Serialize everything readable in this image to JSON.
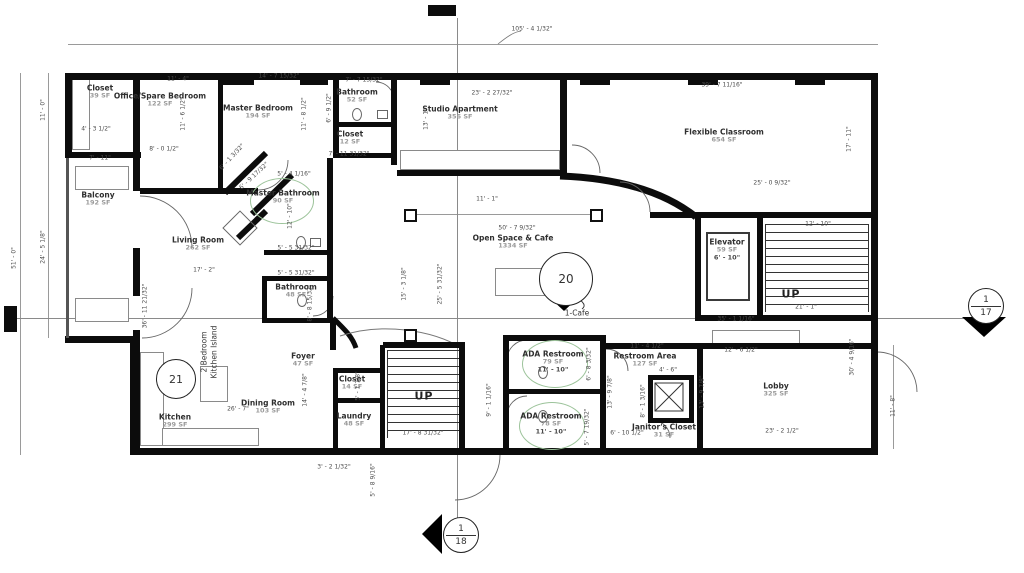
{
  "drawing": {
    "type": "architectural floor plan"
  },
  "colors": {
    "wall": "#0c0c0c",
    "room_label": "#2f2f2f",
    "area_label": "#9a9a9a",
    "dimension": "#4a4a4a",
    "revision_cloud": "#9cc39a"
  },
  "rooms": [
    {
      "name": "Closet",
      "area": "39 SF",
      "x": 100,
      "y": 92
    },
    {
      "name": "Office/Spare Bedroom",
      "area": "122 SF",
      "x": 160,
      "y": 100
    },
    {
      "name": "Master Bedroom",
      "area": "194 SF",
      "x": 258,
      "y": 112
    },
    {
      "name": "Bathroom",
      "area": "52 SF",
      "x": 357,
      "y": 96
    },
    {
      "name": "Closet",
      "area": "12 SF",
      "x": 350,
      "y": 138
    },
    {
      "name": "Studio Apartment",
      "area": "356 SF",
      "x": 460,
      "y": 113
    },
    {
      "name": "Flexible Classroom",
      "area": "654 SF",
      "x": 724,
      "y": 136
    },
    {
      "name": "Balcony",
      "area": "192 SF",
      "x": 98,
      "y": 199
    },
    {
      "name": "Master Bathroom",
      "area": "90 SF",
      "x": 283,
      "y": 197
    },
    {
      "name": "Living Room",
      "area": "262 SF",
      "x": 198,
      "y": 244
    },
    {
      "name": "Bathroom",
      "area": "48 SF",
      "x": 296,
      "y": 291
    },
    {
      "name": "Open Space & Cafe",
      "area": "1334 SF",
      "x": 513,
      "y": 242
    },
    {
      "name": "Elevator",
      "area": "59 SF",
      "extra": "6' - 10\"",
      "x": 727,
      "y": 250
    },
    {
      "name": "Kitchen",
      "area": "299 SF",
      "x": 175,
      "y": 421
    },
    {
      "name": "Dining Room",
      "area": "103 SF",
      "x": 268,
      "y": 407
    },
    {
      "name": "Foyer",
      "area": "47 SF",
      "x": 303,
      "y": 360
    },
    {
      "name": "Closet",
      "area": "14 SF",
      "x": 352,
      "y": 383
    },
    {
      "name": "Laundry",
      "area": "48 SF",
      "x": 354,
      "y": 420
    },
    {
      "name": "ADA Restroom",
      "area": "79 SF",
      "extra": "11' - 10\"",
      "x": 553,
      "y": 362
    },
    {
      "name": "ADA Restroom",
      "area": "78 SF",
      "extra": "11' - 10\"",
      "x": 551,
      "y": 424
    },
    {
      "name": "Restroom Area",
      "area": "127 SF",
      "x": 645,
      "y": 360
    },
    {
      "name": "Janitor's Closet",
      "area": "31 SF",
      "x": 664,
      "y": 431
    },
    {
      "name": "Lobby",
      "area": "325 SF",
      "x": 776,
      "y": 390
    }
  ],
  "dimensions": [
    {
      "text": "105' - 4 1/32\"",
      "x": 532,
      "y": 29,
      "rot": 0
    },
    {
      "text": "11' - 4\"",
      "x": 178,
      "y": 79,
      "rot": 0
    },
    {
      "text": "14' - 7 15/32\"",
      "x": 279,
      "y": 76,
      "rot": 0
    },
    {
      "text": "7' - 7 15/32\"",
      "x": 364,
      "y": 80,
      "rot": 0
    },
    {
      "text": "23' - 2 27/32\"",
      "x": 492,
      "y": 93,
      "rot": 0
    },
    {
      "text": "39' - 7 11/16\"",
      "x": 722,
      "y": 85,
      "rot": 0
    },
    {
      "text": "51' - 0\"",
      "x": 14,
      "y": 258,
      "rot": -90
    },
    {
      "text": "11' - 0\"",
      "x": 43,
      "y": 110,
      "rot": -90
    },
    {
      "text": "24' - 5 1/8\"",
      "x": 43,
      "y": 247,
      "rot": -90
    },
    {
      "text": "4' - 3 1/2\"",
      "x": 96,
      "y": 129,
      "rot": 0
    },
    {
      "text": "7' - 11\"",
      "x": 100,
      "y": 158,
      "rot": 0
    },
    {
      "text": "8' - 0 1/2\"",
      "x": 164,
      "y": 149,
      "rot": 0
    },
    {
      "text": "11' - 6 1/2\"",
      "x": 183,
      "y": 114,
      "rot": -90
    },
    {
      "text": "11' - 8 1/2\"",
      "x": 304,
      "y": 114,
      "rot": -90
    },
    {
      "text": "6' - 9 1/2\"",
      "x": 329,
      "y": 108,
      "rot": -90
    },
    {
      "text": "7' - 11 31/32\"",
      "x": 349,
      "y": 154,
      "rot": 0
    },
    {
      "text": "13' - 1\"",
      "x": 426,
      "y": 119,
      "rot": -90
    },
    {
      "text": "17' - 11\"",
      "x": 849,
      "y": 139,
      "rot": -90
    },
    {
      "text": "25' - 0 9/32\"",
      "x": 772,
      "y": 183,
      "rot": 0
    },
    {
      "text": "6' - 1 3/32\"",
      "x": 232,
      "y": 157,
      "rot": -47
    },
    {
      "text": "6' - 9 17/32\"",
      "x": 254,
      "y": 176,
      "rot": -43
    },
    {
      "text": "5' - 4 1/16\"",
      "x": 294,
      "y": 174,
      "rot": 0
    },
    {
      "text": "12' - 10\"",
      "x": 290,
      "y": 216,
      "rot": -90
    },
    {
      "text": "5' - 5 31/32\"",
      "x": 296,
      "y": 248,
      "rot": 0
    },
    {
      "text": "5' - 5 31/32\"",
      "x": 296,
      "y": 273,
      "rot": 0
    },
    {
      "text": "8' - 8 15/32\"",
      "x": 310,
      "y": 303,
      "rot": -90
    },
    {
      "text": "17' - 2\"",
      "x": 204,
      "y": 270,
      "rot": 0
    },
    {
      "text": "36' - 11 21/32\"",
      "x": 145,
      "y": 306,
      "rot": -90
    },
    {
      "text": "11' - 1\"",
      "x": 487,
      "y": 199,
      "rot": 0
    },
    {
      "text": "50' - 7 9/32\"",
      "x": 517,
      "y": 228,
      "rot": 0
    },
    {
      "text": "15' - 3 1/8\"",
      "x": 404,
      "y": 284,
      "rot": -90
    },
    {
      "text": "25' - 5 31/32\"",
      "x": 440,
      "y": 284,
      "rot": -90
    },
    {
      "text": "12' - 10\"",
      "x": 818,
      "y": 224,
      "rot": 0
    },
    {
      "text": "21' - 1\"",
      "x": 806,
      "y": 307,
      "rot": 0
    },
    {
      "text": "35' - 1 1/16\"",
      "x": 736,
      "y": 319,
      "rot": 0
    },
    {
      "text": "12' - 6 1/2\"",
      "x": 741,
      "y": 350,
      "rot": 0
    },
    {
      "text": "30' - 4 9/16\"",
      "x": 852,
      "y": 357,
      "rot": -90
    },
    {
      "text": "11' - 8\"",
      "x": 893,
      "y": 406,
      "rot": -90
    },
    {
      "text": "23' - 2 1/2\"",
      "x": 782,
      "y": 431,
      "rot": 0
    },
    {
      "text": "13' - 9 7/8\"",
      "x": 610,
      "y": 392,
      "rot": -90
    },
    {
      "text": "13' - 9 7/8\"",
      "x": 702,
      "y": 392,
      "rot": -90
    },
    {
      "text": "11' - 4 1/2\"",
      "x": 647,
      "y": 346,
      "rot": 0
    },
    {
      "text": "4' - 6\"",
      "x": 668,
      "y": 370,
      "rot": 0
    },
    {
      "text": "8' - 1 3/16\"",
      "x": 643,
      "y": 401,
      "rot": -90
    },
    {
      "text": "6' - 10 1/2\"",
      "x": 627,
      "y": 433,
      "rot": 0
    },
    {
      "text": "6' - 8 3/32\"",
      "x": 589,
      "y": 364,
      "rot": -90
    },
    {
      "text": "5' - 7 19/32\"",
      "x": 587,
      "y": 427,
      "rot": -90
    },
    {
      "text": "9' - 1 1/16\"",
      "x": 489,
      "y": 400,
      "rot": -90
    },
    {
      "text": "17' - 8 31/32\"",
      "x": 423,
      "y": 433,
      "rot": 0
    },
    {
      "text": "3' - 2 1/32\"",
      "x": 334,
      "y": 467,
      "rot": 0
    },
    {
      "text": "5' - 8 9/16\"",
      "x": 373,
      "y": 480,
      "rot": -90
    },
    {
      "text": "14' - 4 7/8\"",
      "x": 305,
      "y": 390,
      "rot": -90
    },
    {
      "text": "5' - 1 7/8\"",
      "x": 358,
      "y": 386,
      "rot": -90
    },
    {
      "text": "26' - 7\"",
      "x": 238,
      "y": 409,
      "rot": 0
    }
  ],
  "markers": {
    "cafe_callout": {
      "number": "20",
      "label": "1-Cafe"
    },
    "kitchen_callout": {
      "number": "21",
      "note": [
        "2 Bedroom",
        "Kitchen Island"
      ]
    },
    "section_marker_right": {
      "sheet": "1",
      "detail": "17"
    },
    "section_marker_bottom": {
      "sheet": "1",
      "detail": "18"
    },
    "stair_direction_center": "UP",
    "stair_direction_right": "UP"
  }
}
